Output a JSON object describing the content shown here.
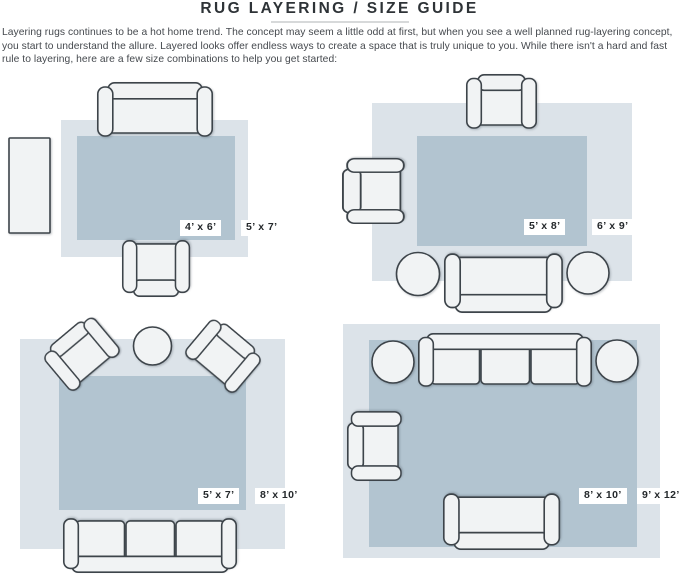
{
  "header": {
    "title": "RUG LAYERING / SIZE GUIDE",
    "intro": "Layering rugs continues to be a hot home trend. The concept may seem a little odd at first, but when you see a well planned rug-layering concept, you start to understand the allure. Layered looks offer endless ways to create a space that is truly unique to you. While there isn't a hard and fast rule to layering, here are a few size combinations to help you get started:"
  },
  "panels": [
    {
      "name": "top-left",
      "inner_rug_size": "4’ x 6’",
      "outer_rug_size": "5’ x 7’"
    },
    {
      "name": "top-right",
      "inner_rug_size": "5’ x 8’",
      "outer_rug_size": "6’ x 9’"
    },
    {
      "name": "bottom-left",
      "inner_rug_size": "5’ x 7’",
      "outer_rug_size": "8’ x 10’"
    },
    {
      "name": "bottom-right",
      "inner_rug_size": "8’ x 10’",
      "outer_rug_size": "9’ x 12’"
    }
  ],
  "colors": {
    "outer_rug": "#dce3e9",
    "inner_rug": "#b2c4d0",
    "furniture_fill": "#f1f3f4",
    "furniture_stroke": "#3d444a",
    "label_bg": "#ffffff",
    "label_text": "#24282b",
    "title_text": "#2e3337",
    "body_text": "#45494e",
    "divider": "#d7d9da"
  }
}
